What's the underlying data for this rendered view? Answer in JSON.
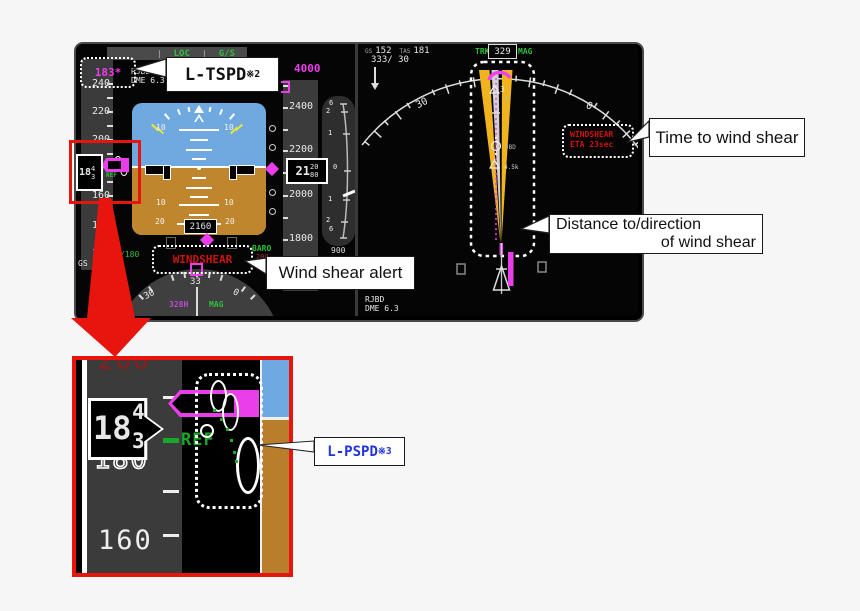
{
  "pfd": {
    "annunciator": {
      "sep1": "|",
      "loc": "LOC",
      "sep2": "|",
      "gs": "G/S"
    },
    "target_speed": "183*",
    "nav_station": "RJBD",
    "nav_dme": "DME 6.3",
    "speed_tape": [
      "240",
      "220",
      "200",
      "180",
      "160",
      "140",
      "120"
    ],
    "speed_box": {
      "tens": "18",
      "roll_top": "4",
      "roll_bottom": "3"
    },
    "ref_label": "REF",
    "gs_text": "GS 152",
    "sel_speed": "/180",
    "adi": {
      "pitch10": "10",
      "pitch20": "20",
      "radio_alt": "2160"
    },
    "selected_altitude": "4000",
    "alt_tape": [
      "2400",
      "2200",
      "2000",
      "1800"
    ],
    "alt_box": {
      "big": "21",
      "roll_top": "20",
      "roll_bottom": "80"
    },
    "vsi": {
      "labels": [
        "6",
        "2",
        "1",
        "0",
        "1",
        "2",
        "6"
      ],
      "value": "900"
    },
    "baro": {
      "label": "BARO",
      "value": "200"
    },
    "windshear_alert": "WINDSHEAR",
    "compass": {
      "center": "33",
      "left": "30",
      "right": "0",
      "hdg": "328H",
      "ref": "MAG"
    }
  },
  "nd": {
    "gs_label": "GS",
    "gs": "152",
    "tas_label": "TAS",
    "tas": "181",
    "wind": "333/ 30",
    "trk_label": "TRK",
    "trk": "329",
    "mag": "MAG",
    "compass_left": "30",
    "compass_right": "0",
    "compass_center": "3",
    "wpt1": "k",
    "wpt2": "JBD",
    "wpt3": "4.5k",
    "eta_box": {
      "line1": "WINDSHEAR",
      "line2": "ETA 23sec"
    },
    "station": "RJBD",
    "dme": "DME 6.3"
  },
  "inset": {
    "top_label": "200",
    "bottom_label": "160",
    "speed_box": {
      "tens": "18",
      "roll_top": "4",
      "roll_bottom": "3"
    },
    "hidden_label": "180",
    "ref_label": "REF"
  },
  "callouts": {
    "tspd": {
      "label": "L-TSPD",
      "note": "※2"
    },
    "pspd": {
      "label": "L-PSPD",
      "note": "※3"
    },
    "time": "Time to wind shear",
    "dist_line1": "Distance to/direction",
    "dist_line2": "of wind shear",
    "alert": "Wind shear alert"
  },
  "colors": {
    "magenta": "#e93ee9",
    "green": "#2fbf3f",
    "alert_red": "#cf1310",
    "cone_yellow": "#f0b41e",
    "callout_blue": "#2233dd",
    "accent_red": "#e8150f",
    "sky_blue": "#6fa9e2",
    "ground_brown": "#b97e2b"
  }
}
